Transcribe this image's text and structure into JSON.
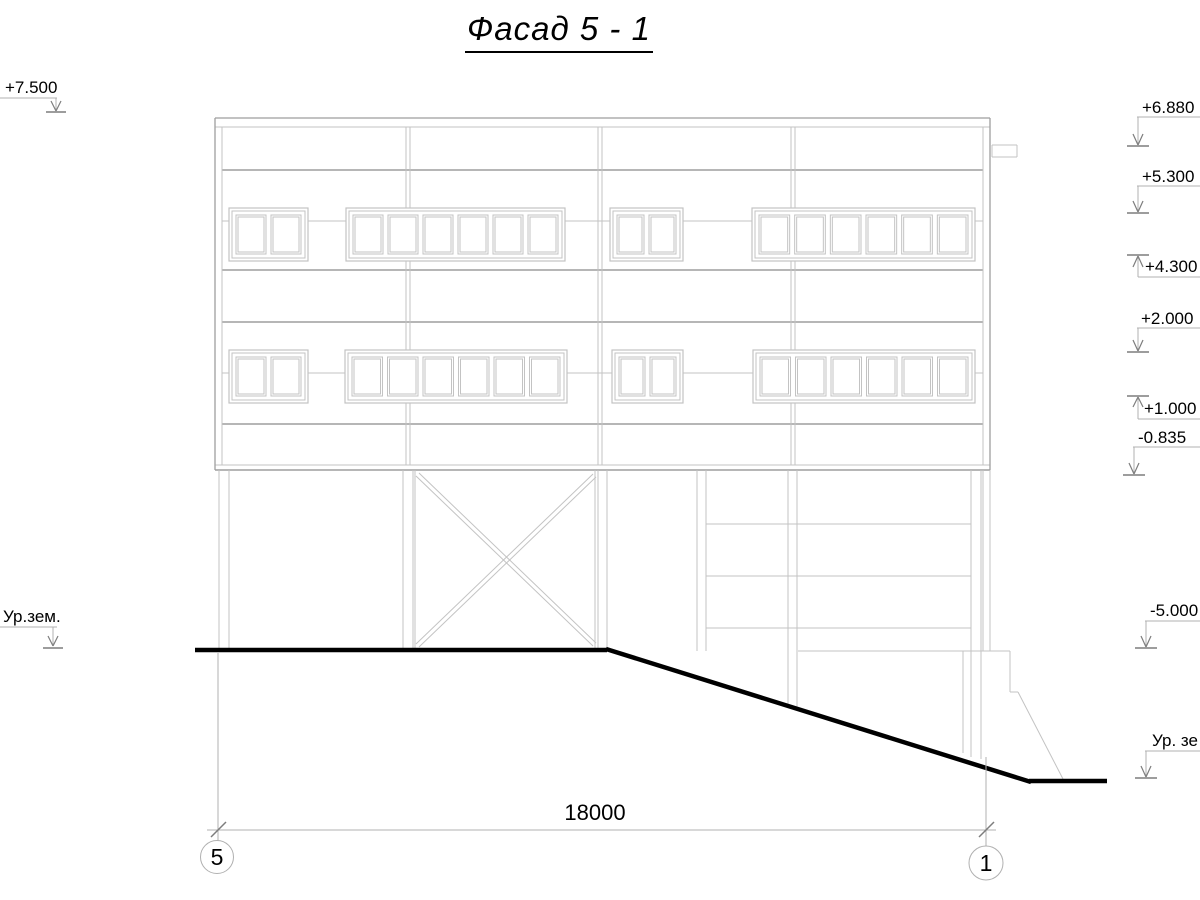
{
  "title": {
    "text": "Фасад 5 - 1"
  },
  "drawing": {
    "palette": {
      "t": "#c3c3c3",
      "m": "#9e9e9e",
      "g": "#b0b0b0",
      "d": "#7d7d7d",
      "k": "#000000"
    },
    "building": {
      "lines": [
        [
          215,
          118,
          990,
          118,
          "m",
          1.3
        ],
        [
          215,
          127,
          990,
          127,
          "t",
          1
        ],
        [
          222,
          170,
          983,
          170,
          "m",
          1.6
        ],
        [
          222,
          270,
          983,
          270,
          "m",
          1.6
        ],
        [
          222,
          322,
          983,
          322,
          "m",
          1.6
        ],
        [
          222,
          424,
          983,
          424,
          "m",
          1.6
        ],
        [
          215,
          465,
          990,
          465,
          "t",
          1
        ],
        [
          215,
          470,
          990,
          470,
          "m",
          1.4
        ],
        [
          215,
          118,
          215,
          470,
          "m",
          1.3
        ],
        [
          222,
          127,
          222,
          465,
          "t",
          1
        ],
        [
          990,
          118,
          990,
          470,
          "m",
          1.3
        ],
        [
          983,
          127,
          983,
          465,
          "t",
          1
        ],
        [
          222,
          221,
          229,
          221,
          "t",
          1
        ],
        [
          308,
          221,
          346,
          221,
          "t",
          1
        ],
        [
          565,
          221,
          610,
          221,
          "t",
          1
        ],
        [
          683,
          221,
          752,
          221,
          "t",
          1
        ],
        [
          975,
          221,
          983,
          221,
          "t",
          1
        ],
        [
          222,
          373,
          229,
          373,
          "t",
          1
        ],
        [
          308,
          373,
          345,
          373,
          "t",
          1
        ],
        [
          567,
          373,
          612,
          373,
          "t",
          1
        ],
        [
          683,
          373,
          753,
          373,
          "t",
          1
        ],
        [
          975,
          373,
          983,
          373,
          "t",
          1
        ],
        [
          406,
          127,
          406,
          208,
          "t",
          1
        ],
        [
          410,
          127,
          410,
          208,
          "t",
          1
        ],
        [
          406,
          261,
          406,
          350,
          "t",
          1
        ],
        [
          410,
          261,
          410,
          350,
          "t",
          1
        ],
        [
          406,
          403,
          406,
          465,
          "t",
          1
        ],
        [
          410,
          403,
          410,
          465,
          "t",
          1
        ],
        [
          598,
          127,
          598,
          465,
          "t",
          1
        ],
        [
          602,
          127,
          602,
          465,
          "t",
          1
        ],
        [
          791,
          127,
          791,
          208,
          "t",
          1
        ],
        [
          795,
          127,
          795,
          208,
          "t",
          1
        ],
        [
          791,
          261,
          791,
          350,
          "t",
          1
        ],
        [
          795,
          261,
          795,
          350,
          "t",
          1
        ],
        [
          791,
          403,
          791,
          465,
          "t",
          1
        ],
        [
          795,
          403,
          795,
          465,
          "t",
          1
        ],
        [
          992,
          145,
          1017,
          145,
          "t",
          1
        ],
        [
          1017,
          145,
          1017,
          157,
          "t",
          1
        ],
        [
          992,
          157,
          1017,
          157,
          "t",
          1
        ],
        [
          992,
          145,
          992,
          157,
          "t",
          1
        ]
      ]
    },
    "windows": [
      {
        "x": 229,
        "y": 208,
        "w": 79,
        "h": 53,
        "panes": 2
      },
      {
        "x": 346,
        "y": 208,
        "w": 219,
        "h": 53,
        "panes": 6
      },
      {
        "x": 610,
        "y": 208,
        "w": 73,
        "h": 53,
        "panes": 2
      },
      {
        "x": 752,
        "y": 208,
        "w": 223,
        "h": 53,
        "panes": 6
      },
      {
        "x": 229,
        "y": 350,
        "w": 79,
        "h": 53,
        "panes": 2
      },
      {
        "x": 345,
        "y": 350,
        "w": 222,
        "h": 53,
        "panes": 6
      },
      {
        "x": 612,
        "y": 350,
        "w": 71,
        "h": 53,
        "panes": 2
      },
      {
        "x": 753,
        "y": 350,
        "w": 222,
        "h": 53,
        "panes": 6
      }
    ],
    "structure": {
      "lines": [
        [
          219,
          470,
          219,
          650,
          "t",
          1
        ],
        [
          229,
          470,
          229,
          650,
          "t",
          1
        ],
        [
          403,
          470,
          403,
          650,
          "t",
          1
        ],
        [
          413,
          470,
          413,
          650,
          "t",
          1
        ],
        [
          598,
          470,
          598,
          650,
          "t",
          1
        ],
        [
          607,
          470,
          607,
          650,
          "t",
          1
        ],
        [
          697,
          470,
          697,
          651,
          "t",
          1
        ],
        [
          706,
          470,
          706,
          651,
          "t",
          1
        ],
        [
          788,
          470,
          788,
          708,
          "t",
          1
        ],
        [
          797,
          470,
          797,
          710,
          "t",
          1
        ],
        [
          971,
          470,
          971,
          757,
          "t",
          1
        ],
        [
          981,
          470,
          981,
          759,
          "t",
          1
        ],
        [
          983,
          470,
          983,
          651,
          "t",
          1
        ],
        [
          990,
          470,
          990,
          651,
          "t",
          1
        ],
        [
          415,
          470,
          415,
          650,
          "t",
          1
        ],
        [
          595,
          470,
          595,
          650,
          "t",
          1
        ],
        [
          416,
          476,
          593,
          646,
          "t",
          1
        ],
        [
          419,
          473,
          596,
          643,
          "t",
          1
        ],
        [
          416,
          644,
          593,
          474,
          "t",
          1
        ],
        [
          419,
          647,
          596,
          477,
          "t",
          1
        ],
        [
          706,
          524,
          971,
          524,
          "t",
          1
        ],
        [
          706,
          576,
          971,
          576,
          "t",
          1
        ],
        [
          706,
          628,
          971,
          628,
          "t",
          1
        ],
        [
          798,
          651,
          1010,
          651,
          "t",
          1
        ],
        [
          963,
          651,
          963,
          753,
          "t",
          1
        ],
        [
          1010,
          651,
          1010,
          692,
          "t",
          1
        ],
        [
          1010,
          692,
          1018,
          692,
          "t",
          1
        ],
        [
          1018,
          692,
          1063,
          779,
          "t",
          1
        ]
      ]
    },
    "ground": {
      "lines": [
        [
          195,
          650,
          607,
          650,
          "k",
          4.5
        ],
        [
          606,
          649,
          1031,
          782,
          "k",
          4.5
        ],
        [
          1029,
          781,
          1107,
          781,
          "k",
          4.5
        ]
      ]
    },
    "marks": {
      "lines": [
        [
          0,
          98,
          57,
          98,
          "g",
          1
        ],
        [
          56,
          98,
          56,
          110,
          "g",
          1
        ],
        [
          51,
          101,
          56,
          111,
          "d",
          1.2
        ],
        [
          61,
          101,
          56,
          111,
          "d",
          1.2
        ],
        [
          46,
          112,
          66,
          112,
          "d",
          1.5
        ],
        [
          0,
          627,
          57,
          627,
          "g",
          1
        ],
        [
          53,
          627,
          53,
          645,
          "g",
          1
        ],
        [
          48,
          636,
          53,
          646,
          "d",
          1.2
        ],
        [
          58,
          636,
          53,
          646,
          "d",
          1.2
        ],
        [
          43,
          648,
          63,
          648,
          "d",
          1.5
        ],
        [
          1137,
          117,
          1200,
          117,
          "g",
          1
        ],
        [
          1138,
          117,
          1138,
          144,
          "g",
          1
        ],
        [
          1133,
          134,
          1138,
          145,
          "d",
          1.2
        ],
        [
          1143,
          134,
          1138,
          145,
          "d",
          1.2
        ],
        [
          1127,
          146,
          1149,
          146,
          "d",
          1.5
        ],
        [
          1137,
          186,
          1200,
          186,
          "g",
          1
        ],
        [
          1138,
          186,
          1138,
          211,
          "g",
          1
        ],
        [
          1133,
          201,
          1138,
          212,
          "d",
          1.2
        ],
        [
          1143,
          201,
          1138,
          212,
          "d",
          1.2
        ],
        [
          1127,
          213,
          1149,
          213,
          "d",
          1.5
        ],
        [
          1127,
          255,
          1149,
          255,
          "d",
          1.5
        ],
        [
          1138,
          256,
          1138,
          277,
          "g",
          1
        ],
        [
          1133,
          267,
          1138,
          256,
          "d",
          1.2
        ],
        [
          1143,
          267,
          1138,
          256,
          "d",
          1.2
        ],
        [
          1138,
          277,
          1200,
          277,
          "g",
          1
        ],
        [
          1137,
          328,
          1200,
          328,
          "g",
          1
        ],
        [
          1138,
          328,
          1138,
          350,
          "g",
          1
        ],
        [
          1133,
          340,
          1138,
          351,
          "d",
          1.2
        ],
        [
          1143,
          340,
          1138,
          351,
          "d",
          1.2
        ],
        [
          1127,
          352,
          1149,
          352,
          "d",
          1.5
        ],
        [
          1127,
          396,
          1149,
          396,
          "d",
          1.5
        ],
        [
          1138,
          397,
          1138,
          419,
          "g",
          1
        ],
        [
          1133,
          407,
          1138,
          397,
          "d",
          1.2
        ],
        [
          1143,
          407,
          1138,
          397,
          "d",
          1.2
        ],
        [
          1138,
          419,
          1200,
          419,
          "g",
          1
        ],
        [
          1133,
          447,
          1200,
          447,
          "g",
          1
        ],
        [
          1134,
          447,
          1134,
          473,
          "g",
          1
        ],
        [
          1129,
          463,
          1134,
          474,
          "d",
          1.2
        ],
        [
          1139,
          463,
          1134,
          474,
          "d",
          1.2
        ],
        [
          1123,
          475,
          1145,
          475,
          "d",
          1.5
        ],
        [
          1145,
          621,
          1200,
          621,
          "g",
          1
        ],
        [
          1146,
          621,
          1146,
          646,
          "g",
          1
        ],
        [
          1141,
          636,
          1146,
          647,
          "d",
          1.2
        ],
        [
          1151,
          636,
          1146,
          647,
          "d",
          1.2
        ],
        [
          1135,
          648,
          1157,
          648,
          "d",
          1.5
        ],
        [
          1145,
          751,
          1200,
          751,
          "g",
          1
        ],
        [
          1146,
          751,
          1146,
          776,
          "g",
          1
        ],
        [
          1141,
          766,
          1146,
          777,
          "d",
          1.2
        ],
        [
          1151,
          766,
          1146,
          777,
          "d",
          1.2
        ],
        [
          1135,
          778,
          1157,
          778,
          "d",
          1.5
        ]
      ],
      "labels": [
        [
          "+7.500",
          5,
          93,
          17
        ],
        [
          "Ур.зем.",
          3,
          622,
          17
        ],
        [
          "+6.880",
          1142,
          113,
          17
        ],
        [
          "+5.300",
          1142,
          182,
          17
        ],
        [
          "+4.300",
          1145,
          272,
          17
        ],
        [
          "+2.000",
          1141,
          324,
          17
        ],
        [
          "+1.000",
          1144,
          414,
          17
        ],
        [
          "-0.835",
          1138,
          443,
          17
        ],
        [
          "-5.000",
          1150,
          616,
          17
        ],
        [
          "Ур. зе",
          1152,
          746,
          17
        ]
      ]
    },
    "dimension": {
      "lines": [
        [
          218,
          653,
          218,
          841,
          "g",
          1
        ],
        [
          986,
          757,
          986,
          847,
          "g",
          1
        ],
        [
          207,
          830,
          996,
          830,
          "g",
          1
        ],
        [
          211,
          837,
          226,
          822,
          "d",
          1.5
        ],
        [
          979,
          837,
          994,
          822,
          "d",
          1.5
        ]
      ],
      "label": {
        "text": "18000",
        "x": 595,
        "y": 820,
        "size": 22
      }
    },
    "axes": [
      {
        "label": "5",
        "cx": 217,
        "cy": 857,
        "r": 16.5
      },
      {
        "label": "1",
        "cx": 986,
        "cy": 863,
        "r": 17
      }
    ]
  }
}
